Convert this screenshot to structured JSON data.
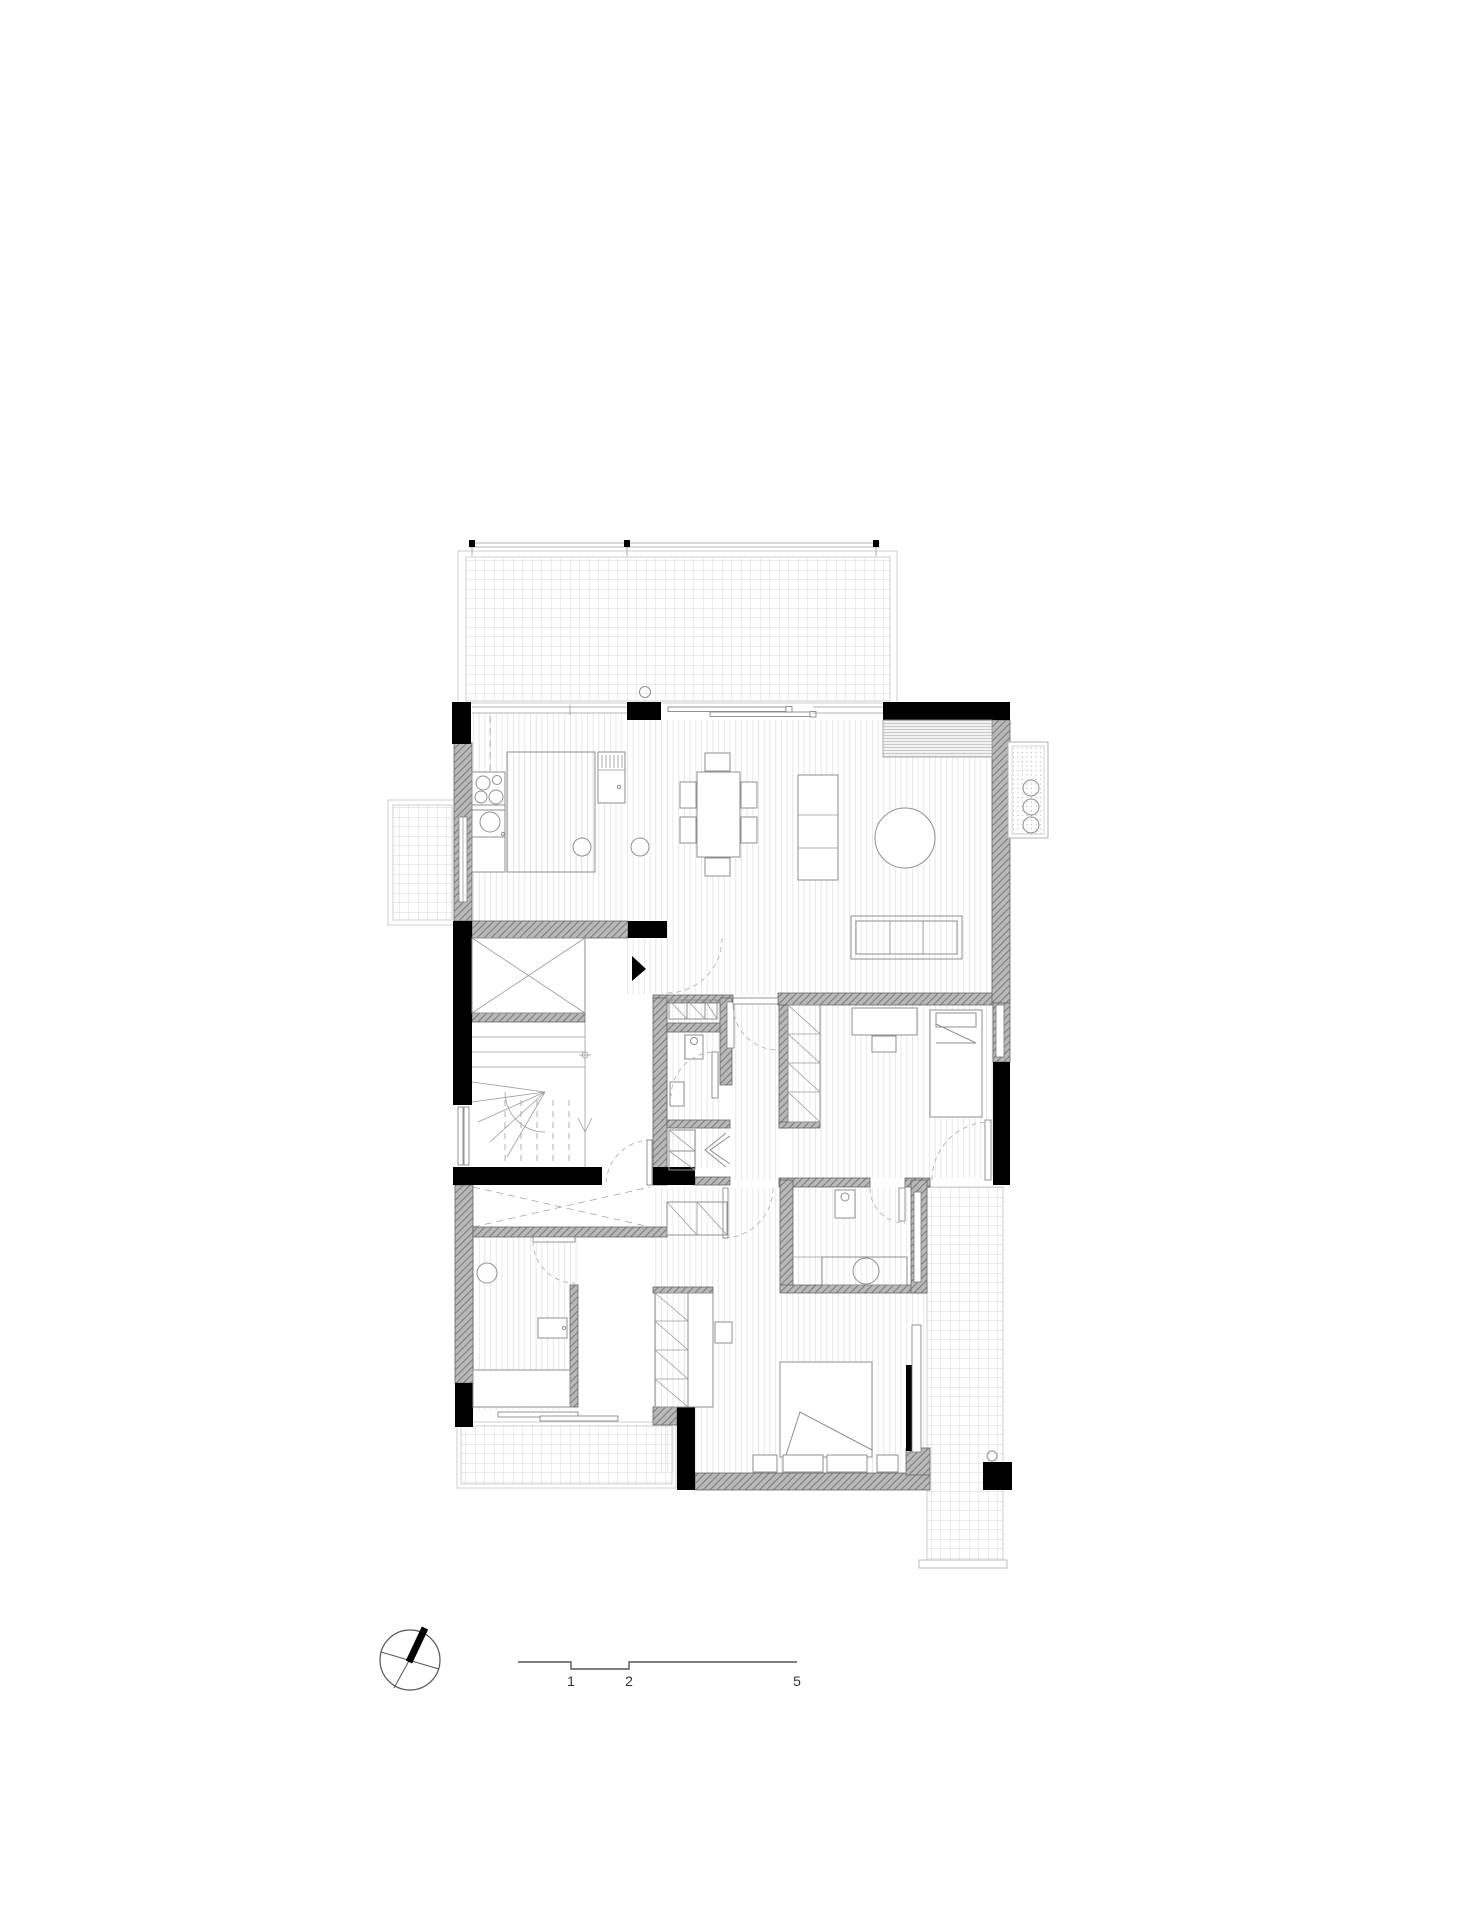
{
  "drawing": {
    "kind": "floor-plan",
    "scale_bar": {
      "labels": [
        "1",
        "2",
        "5"
      ]
    },
    "compass": {
      "icon": "north-arrow-icon"
    },
    "colors": {
      "wall_structural": "#000000",
      "wall_masonry": "#b9b9b9",
      "masonry_hatch_line": "#7d7d7d",
      "floor_plank_line": "#dedede",
      "terrace_tile_line": "#c5cacd",
      "furniture_line": "#8f8f8f",
      "door_swing": "#b3b3b3",
      "annotation": "#333333",
      "background": "#ffffff"
    }
  }
}
